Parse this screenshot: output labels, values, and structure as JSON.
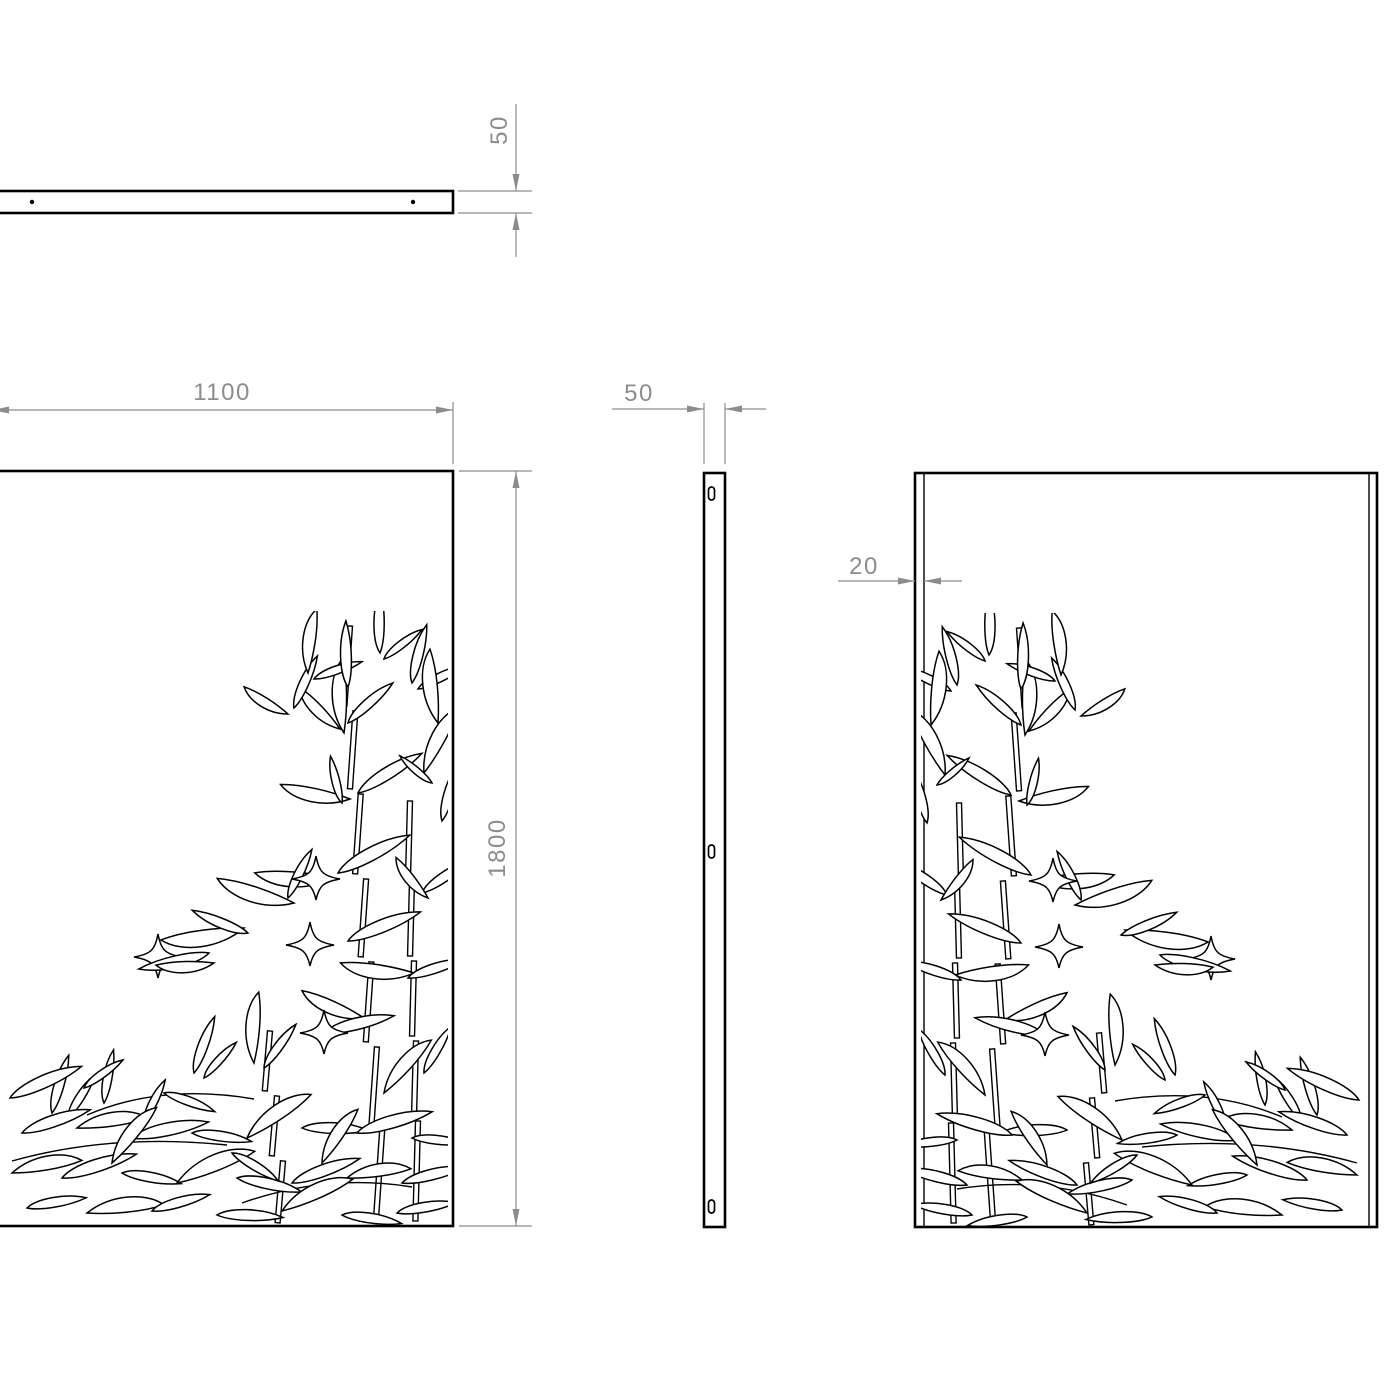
{
  "drawing": {
    "background": "#ffffff",
    "line_color": "#000000",
    "dimension_color": "#8c8c8c",
    "dims": {
      "top_thickness": "50",
      "front_width": "1100",
      "front_height": "1800",
      "side_thickness": "50",
      "back_fold": "20"
    }
  }
}
